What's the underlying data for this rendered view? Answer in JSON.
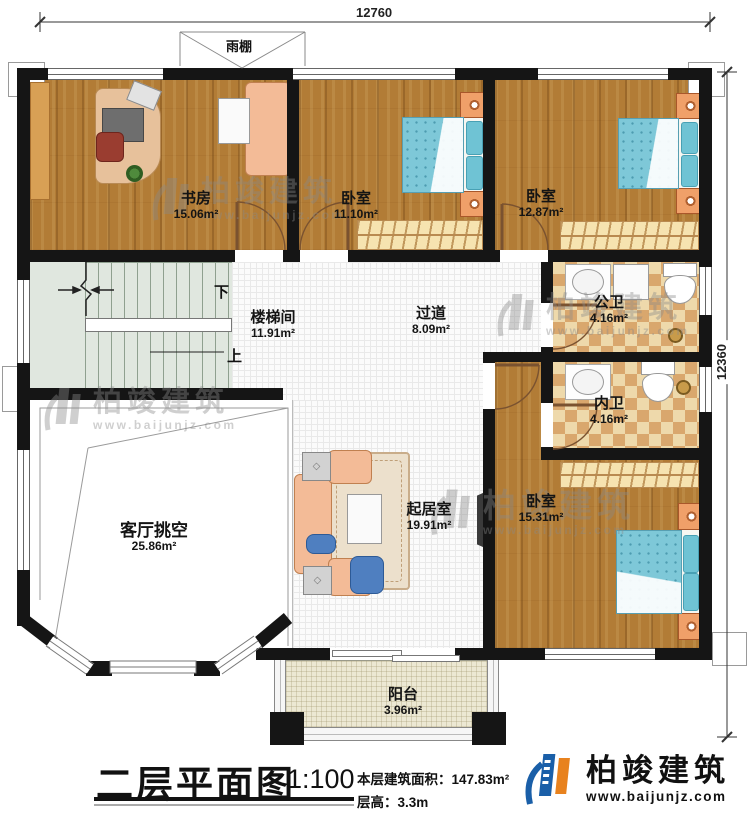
{
  "title_block": {
    "title": "二层平面图",
    "scale": "1:100",
    "area_label": "本层建筑面积：",
    "area_value": "147.83m²",
    "floor_height_label": "层高：",
    "floor_height_value": "3.3m"
  },
  "logo": {
    "name": "柏竣建筑",
    "website": "www.baijunjz.com"
  },
  "watermark": {
    "name": "柏竣建筑",
    "website": "www.baijunjz.com"
  },
  "dimensions": {
    "top": "12760",
    "right": "12360"
  },
  "canopy": {
    "label": "雨棚"
  },
  "stairs": {
    "down": "下",
    "up": "上"
  },
  "rooms": {
    "study": {
      "name": "书房",
      "area": "15.06m²"
    },
    "bedroom_top_middle": {
      "name": "卧室",
      "area": "11.10m²"
    },
    "bedroom_top_right": {
      "name": "卧室",
      "area": "12.87m²"
    },
    "stairwell": {
      "name": "楼梯间",
      "area": "11.91m²"
    },
    "corridor": {
      "name": "过道",
      "area": "8.09m²"
    },
    "public_bath": {
      "name": "公卫",
      "area": "4.16m²"
    },
    "ensuite_bath": {
      "name": "内卫",
      "area": "4.16m²"
    },
    "living_void": {
      "name": "客厅挑空",
      "area": "25.86m²"
    },
    "living_room": {
      "name": "起居室",
      "area": "19.91m²"
    },
    "bedroom_bottom_right": {
      "name": "卧室",
      "area": "15.31m²"
    },
    "balcony": {
      "name": "阳台",
      "area": "3.96m²"
    }
  },
  "colors": {
    "wall": "#151515",
    "wood_floor": "#b27c36",
    "tile_checker": "#d9a76d",
    "stair_floor": "#e0e7df",
    "bed_blue": "#7ec8d8",
    "logo_blue": "#1a5fa8",
    "logo_orange": "#e8821e"
  }
}
